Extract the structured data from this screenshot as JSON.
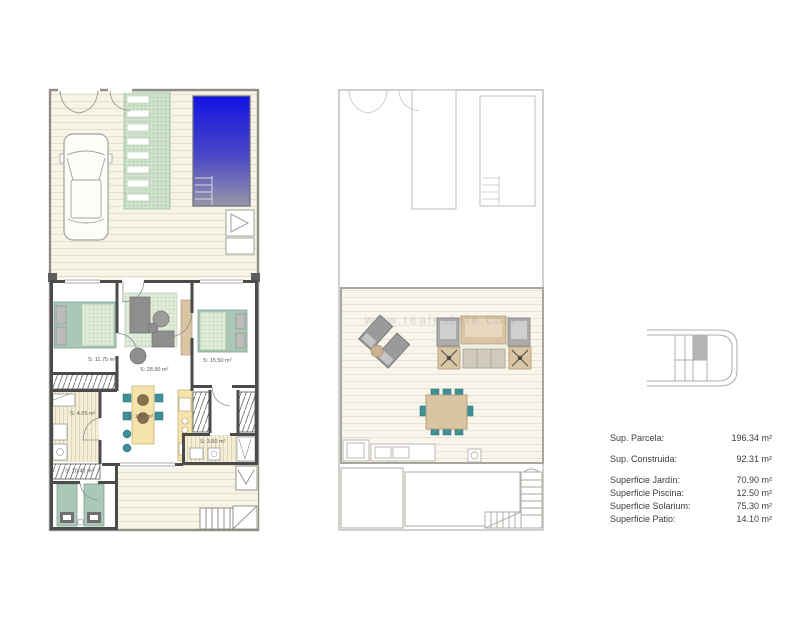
{
  "document": {
    "type": "floor-plan-sheet"
  },
  "ground_floor": {
    "room_labels": {
      "bedroom1": "S: 11.75 m²",
      "living": "S: 28.90 m²",
      "bedroom2": "S: 15.50 m²",
      "bathroom1": "S: 4.05 m²",
      "hall": "S: 1.80 m²",
      "bathroom2": "S: 3.60 m²",
      "patio": "S: 10.40 m²"
    }
  },
  "solarium_floor": {
    "watermark": "www.realestate.com"
  },
  "legend": {
    "rows": [
      {
        "label": "Sup. Parcela:",
        "value": "196.34 m²"
      },
      {
        "label": "Sup. Construida:",
        "value": "92.31 m²"
      },
      {
        "label": "Superficie Jardín:",
        "value": "70.90 m²"
      },
      {
        "label": "Superficie Piscina:",
        "value": "12.50 m²"
      },
      {
        "label": "Superficie Solarium:",
        "value": "75.30 m²"
      },
      {
        "label": "Superficie Patio:",
        "value": "14.10 m²"
      }
    ]
  },
  "colors": {
    "pool_top": "#1412e4",
    "pool_bottom": "#9896a9",
    "deck": "#f6f3e7",
    "garden_path": "#cfe2cb",
    "furniture_teal": "#3f8f96",
    "bed_green": "#aac7b8",
    "wood": "#d9c4a4",
    "kitchen_yellow": "#f5e3ac",
    "sofa_gray": "#8f8f8f"
  }
}
